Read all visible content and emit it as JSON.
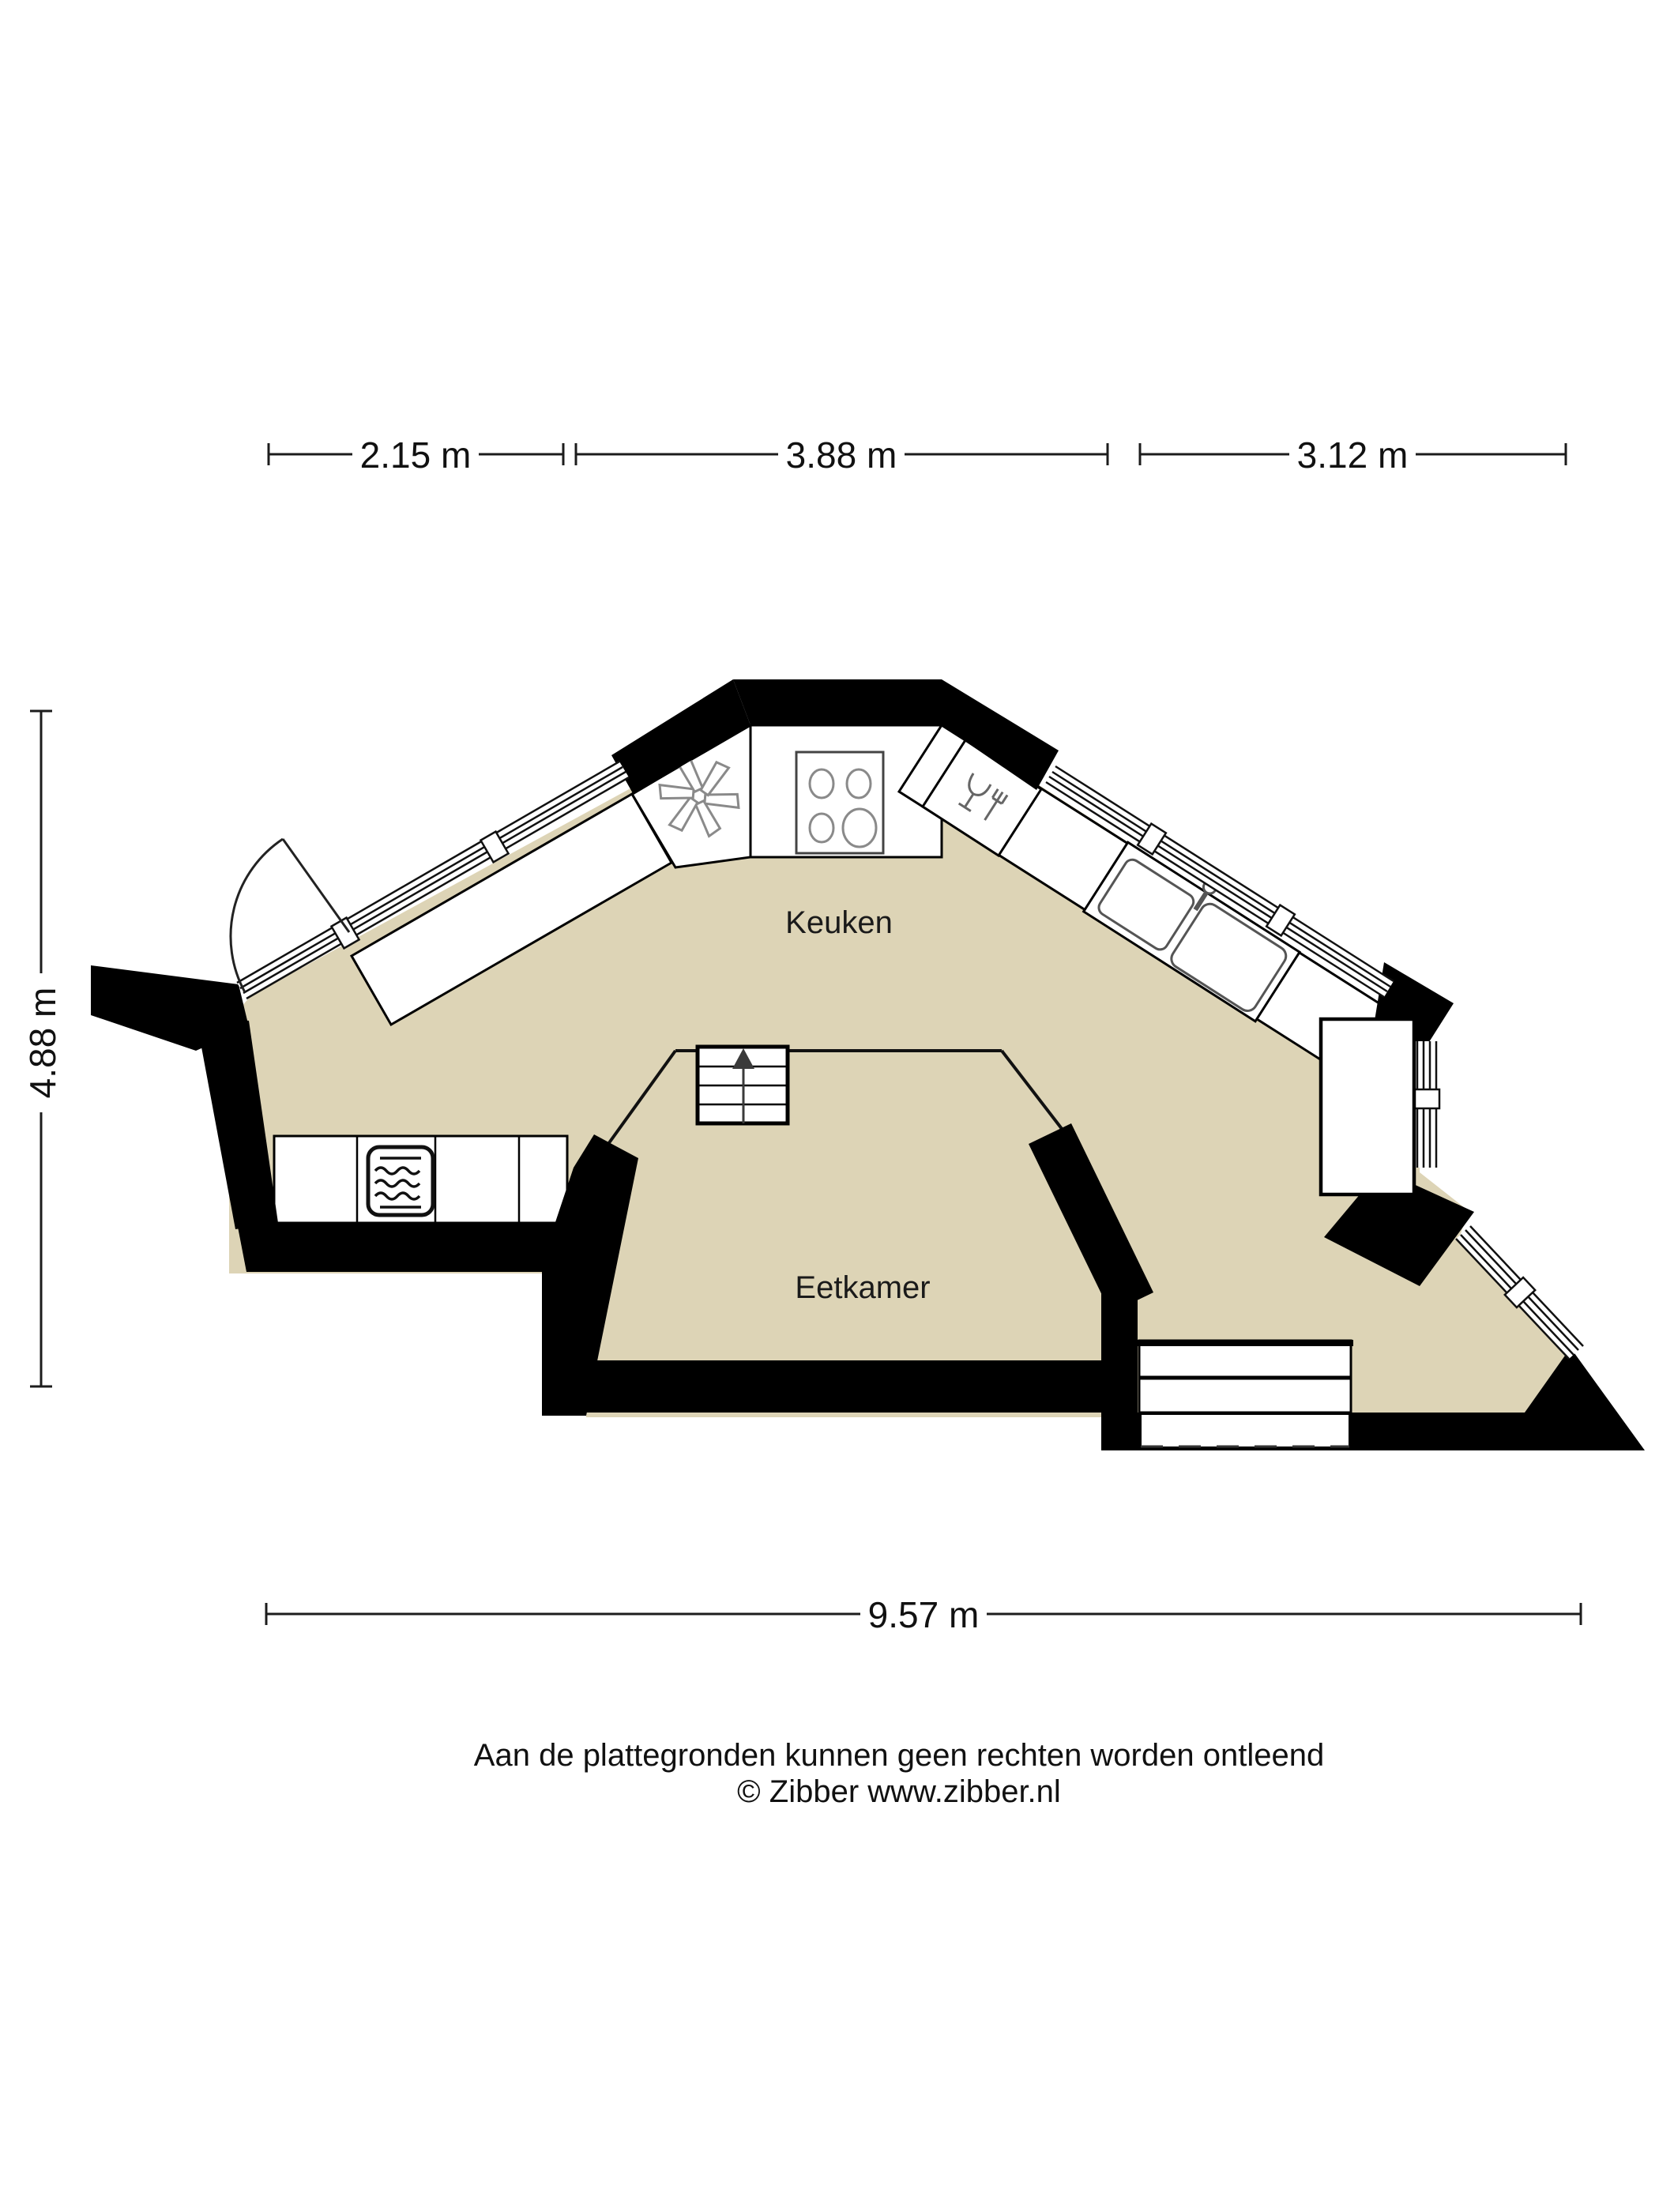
{
  "rooms": {
    "kitchen": {
      "label": "Keuken"
    },
    "dining": {
      "label": "Eetkamer"
    }
  },
  "dimensions": {
    "top": [
      {
        "label": "2.15 m"
      },
      {
        "label": "3.88 m"
      },
      {
        "label": "3.12 m"
      }
    ],
    "left": {
      "label": "4.88 m"
    },
    "bottom": {
      "label": "9.57 m"
    }
  },
  "footer": {
    "disclaimer": "Aan de plattegronden kunnen geen rechten worden ontleend",
    "credit": "© Zibber www.zibber.nl"
  },
  "stairs": {
    "steps": 4,
    "direction_arrow": "up"
  },
  "appliances": [
    {
      "name": "extractor-fan"
    },
    {
      "name": "cooktop",
      "burners": 4
    },
    {
      "name": "dishwasher"
    },
    {
      "name": "sink",
      "basins": 2
    },
    {
      "name": "oven-microwave"
    }
  ],
  "colors": {
    "floor": "#DDD4B6",
    "wall": "#000000",
    "text": "#1A1A1A",
    "appliance_icon": "#8A8A8A"
  }
}
